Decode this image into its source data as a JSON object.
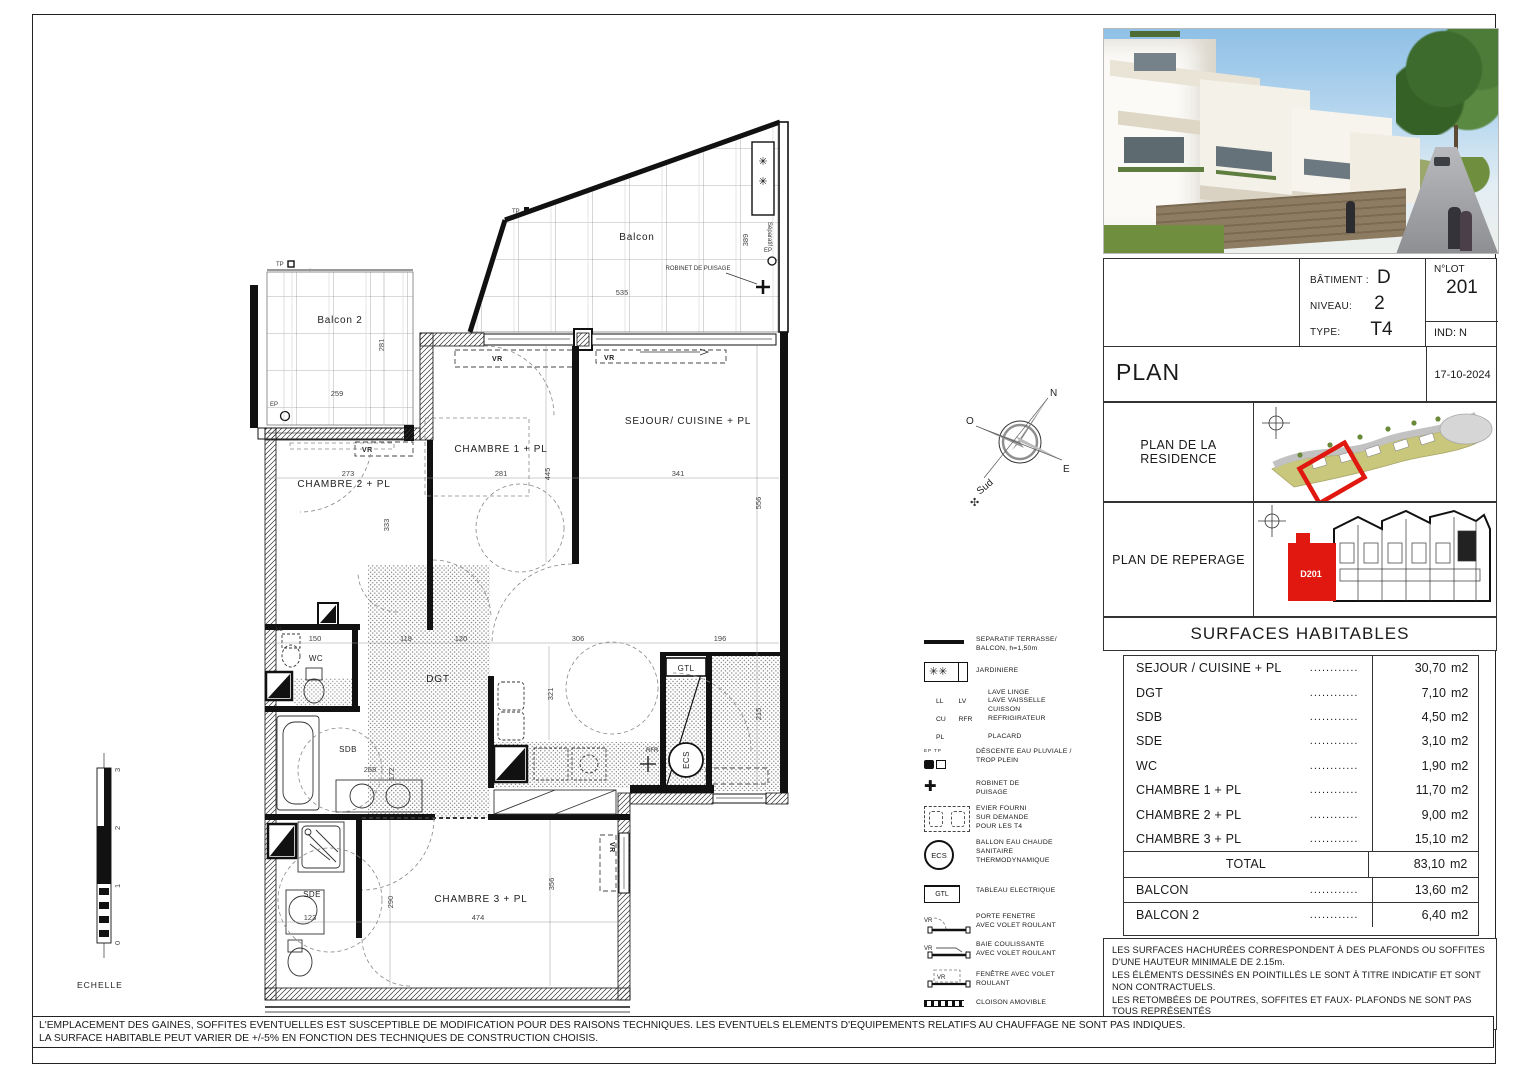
{
  "title_block": {
    "batiment_label": "BÂTIMENT :",
    "batiment_value": "D",
    "niveau_label": "NIVEAU:",
    "niveau_value": "2",
    "type_label": "TYPE:",
    "type_value": "T4",
    "lot_label": "N°LOT",
    "lot_value": "201",
    "ind": "IND: N",
    "plan_title": "PLAN",
    "date": "17-10-2024"
  },
  "panels": {
    "residence_label": "PLAN DE LA RESIDENCE",
    "reperage_label": "PLAN DE REPERAGE",
    "unit_tag": "D201"
  },
  "surfaces": {
    "title": "SURFACES HABITABLES",
    "dots": "............",
    "rows": [
      {
        "label": "SEJOUR / CUISINE + PL",
        "value": "30,70",
        "unit": "m2"
      },
      {
        "label": "DGT",
        "value": "7,10",
        "unit": "m2"
      },
      {
        "label": "SDB",
        "value": "4,50",
        "unit": "m2"
      },
      {
        "label": "SDE",
        "value": "3,10",
        "unit": "m2"
      },
      {
        "label": "WC",
        "value": "1,90",
        "unit": "m2"
      },
      {
        "label": "CHAMBRE 1 + PL",
        "value": "11,70",
        "unit": "m2"
      },
      {
        "label": "CHAMBRE 2 + PL",
        "value": "9,00",
        "unit": "m2"
      },
      {
        "label": "CHAMBRE 3 + PL",
        "value": "15,10",
        "unit": "m2"
      }
    ],
    "total_label": "TOTAL",
    "total_value": "83,10",
    "total_unit": "m2",
    "balcon_rows": [
      {
        "label": "BALCON",
        "value": "13,60",
        "unit": "m2"
      },
      {
        "label": "BALCON 2",
        "value": "6,40",
        "unit": "m2"
      }
    ]
  },
  "notes": {
    "p1": "LES SURFACES HACHURÉES CORRESPONDENT À DES PLAFONDS OU SOFFITES D'UNE HAUTEUR MINIMALE DE  2.15m.",
    "p2": "LES ÉLÉMENTS DESSINÉS EN POINTILLÉS LE SONT À TITRE INDICATIF ET SONT NON CONTRACTUELS.",
    "p3": "LES RETOMBÉES DE POUTRES, SOFFITES ET FAUX- PLAFONDS NE SONT PAS TOUS REPRÉSENTÉS"
  },
  "bottom": {
    "line1": "L'EMPLACEMENT DES GAINES, SOFFITES EVENTUELLES EST SUSCEPTIBLE DE MODIFICATION POUR DES RAISONS TECHNIQUES. LES EVENTUELS ELEMENTS D'EQUIPEMENTS RELATIFS AU CHAUFFAGE NE SONT PAS INDIQUES.",
    "line2": "LA SURFACE HABITABLE PEUT VARIER DE +/-5% EN FONCTION DES TECHNIQUES DE CONSTRUCTION CHOISIS."
  },
  "legend": {
    "separatif": {
      "l1": "SEPARATIF TERRASSE/",
      "l2": "BALCON, h=1,50m"
    },
    "jardiniere": {
      "l1": "JARDINIERE"
    },
    "abbr": [
      {
        "k": "LL",
        "v": "LAVE LINGE"
      },
      {
        "k": "LV",
        "v": "LAVE VAISSELLE"
      },
      {
        "k": "CU",
        "v": "CUISSON"
      },
      {
        "k": "RFR",
        "v": "REFRIGIRATEUR"
      }
    ],
    "placard": {
      "k": "PL",
      "v": "PLACARD"
    },
    "descente": {
      "k": "EP TP",
      "l1": "DÉSCENTE EAU PLUVIALE /",
      "l2": "TROP PLEIN"
    },
    "robinet": {
      "l1": "ROBINET DE",
      "l2": "PUISAGE"
    },
    "evier": {
      "l1": "EVIER FOURNI",
      "l2": "SUR DEMANDE",
      "l3": "POUR LES T4"
    },
    "ecs": {
      "k": "ECS",
      "l1": "BALLON EAU CHAUDE",
      "l2": "SANITAIRE",
      "l3": "THERMODYNAMIQUE"
    },
    "gtl": {
      "k": "GTL",
      "l1": "TABLEAU ELECTRIQUE"
    },
    "porte_fenetre": {
      "l1": "PORTE FENETRE",
      "l2": "AVEC VOLET ROULANT"
    },
    "baie": {
      "l1": "BAIE COULISSANTE",
      "l2": "AVEC VOLET ROULANT"
    },
    "fenetre": {
      "l1": "FENÊTRE AVEC VOLET",
      "l2": "ROULANT"
    },
    "cloison": {
      "l1": "CLOISON AMOVIBLE"
    },
    "faux_plafond": {
      "l1": "FAUX PLAFOND/ SOFFITE"
    }
  },
  "scale": {
    "label": "ECHELLE",
    "t0": "0",
    "t1": "1",
    "t2": "2",
    "t3": "3"
  },
  "compass": {
    "n": "N",
    "o": "O",
    "e": "E",
    "s": "Sud"
  },
  "plan": {
    "balcon": "Balcon",
    "balcon2": "Balcon 2",
    "sejour": "SEJOUR/ CUISINE + PL",
    "ch1": "CHAMBRE 1 + PL",
    "ch2": "CHAMBRE 2 + PL",
    "ch3": "CHAMBRE 3 + PL",
    "dgt": "DGT",
    "wc": "WC",
    "sdb": "SDB",
    "sde": "SDE",
    "robinet": "ROBINET DE PUISAGE",
    "ep": "EP",
    "tp": "TP",
    "vr": "VR",
    "gtl": "GTL",
    "ecs": "ECS",
    "sep": "Séparatif",
    "ll": "LL",
    "rfr": "RFR",
    "dims": {
      "balcon_w": "535",
      "balcon_h": "389",
      "b2_w": "259",
      "b2_h": "281",
      "ch2_w": "273",
      "ch2_h": "333",
      "ch1_w": "281",
      "ch1_h": "445",
      "sej_w": "341",
      "sej_h": "556",
      "wc_w": "150",
      "dgt_a": "119",
      "dgt_b": "120",
      "dgt_c": "306",
      "entry_w": "196",
      "entry_h": "215",
      "kitchen_h": "321",
      "sdb_w": "268",
      "sdb_h": "172",
      "sde_w": "123",
      "ch3_w": "474",
      "ch3_h": "356",
      "ch3_l": "290"
    }
  }
}
